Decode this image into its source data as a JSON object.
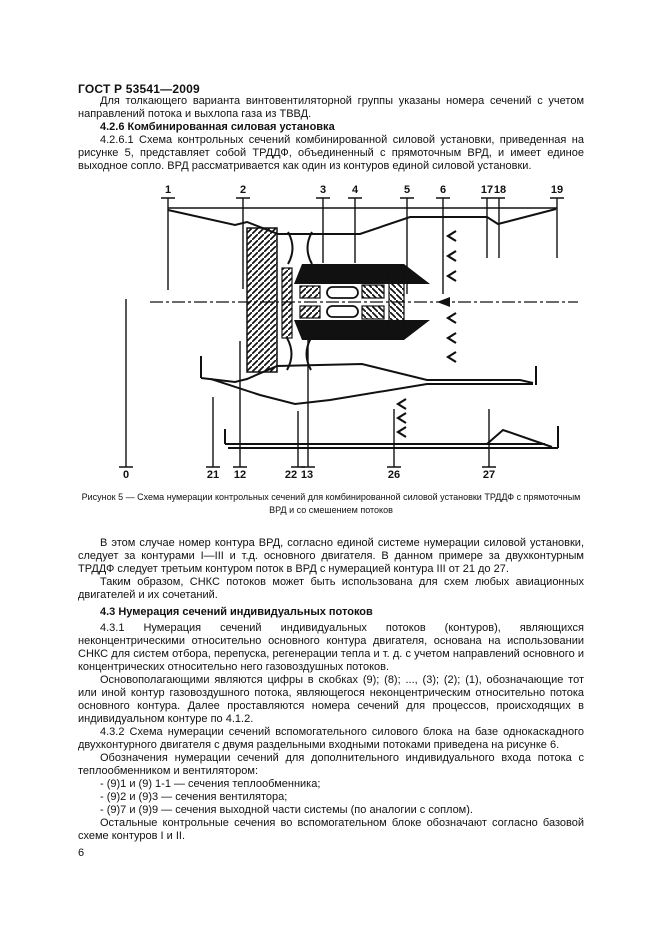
{
  "page": {
    "header": "ГОСТ Р 53541—2009",
    "number": "6"
  },
  "sections": {
    "intro": "Для толкающего варианта винтовентиляторной группы указаны номера сечений с учетом направлений потока и выхлопа газа из ТВВД.",
    "h426": "4.2.6 Комбинированная силовая установка",
    "p4261": "4.2.6.1 Схема контрольных сечений комбинированной силовой установки, приведенная на рисунке 5, представляет собой ТРДДФ, объединенный с прямоточным ВРД, и имеет единое выходное сопло. ВРД рассматривается как один из контуров единой силовой установки.",
    "p_case": "В этом случае номер контура ВРД, согласно единой системе нумерации силовой установки, следует за контурами I—III и т.д. основного двигателя. В данном примере за двухконтурным ТРДДФ следует третьим контуром поток в ВРД с нумерацией контура III от 21 до 27.",
    "p_thus": "Таким образом, СНКС потоков может быть использована для схем любых авиационных двигателей и их сочетаний.",
    "h43": "4.3 Нумерация сечений индивидуальных потоков",
    "p431": "4.3.1 Нумерация сечений индивидуальных потоков (контуров), являющихся неконцентрическими относительно основного контура двигателя, основана на использовании СНКС для систем отбора, перепуска, регенерации тепла и т. д. с учетом направлений основного и концентрических относительно него газовоздушных потоков.",
    "p_fund": "Основополагающими являются цифры в скобках (9); (8); ..., (3); (2); (1), обозначающие тот или иной контур газовоздушного потока, являющегося неконцентрическим относительно потока основного контура. Далее проставляются номера сечений для процессов, происходящих в индивидуальном контуре по 4.1.2.",
    "p432": "4.3.2 Схема нумерации сечений вспомогательного силового блока на базе однокаскадного двухконтурного двигателя с двумя раздельными входными потоками приведена на рисунке 6.",
    "p_denot": "Обозначения нумерации сечений для дополнительного индивидуального входа потока с теплообменником и вентилятором:",
    "list": [
      "- (9)1 и (9) 1-1 — сечения теплообменника;",
      "- (9)2 и (9)3 — сечения вентилятора;",
      "- (9)7 и (9)9 — сечения выходной части системы (по аналогии с соплом)."
    ],
    "p_rest": "Остальные контрольные сечения во вспомогательном блоке обозначают согласно базовой схеме контуров I и II."
  },
  "figure": {
    "caption": "Рисунок 5 — Схема нумерации контрольных сечений для комбинированной силовой установки ТРДДФ с прямоточным ВРД и со смешением потоков",
    "top_sections": [
      "1",
      "2",
      "3",
      "4",
      "5",
      "6",
      "17",
      "18",
      "19"
    ],
    "bottom_sections": [
      "0",
      "21",
      "12",
      "22",
      "13",
      "26",
      "27"
    ],
    "ink_color": "#111111"
  }
}
